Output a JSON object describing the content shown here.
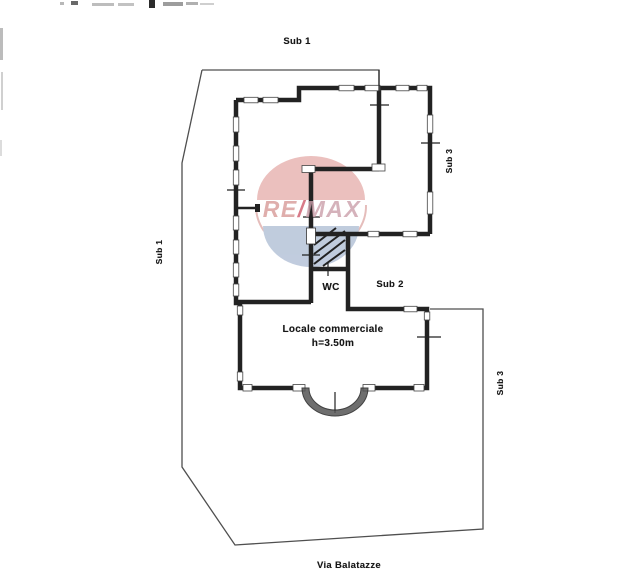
{
  "labels": {
    "sub1_top": "Sub 1",
    "sub1_left": "Sub 1",
    "sub3_upper": "Sub 3",
    "sub2": "Sub 2",
    "wc": "WC",
    "sub3_lower": "Sub 3",
    "room_name": "Locale commerciale",
    "room_height": "h=3.50m",
    "street": "Via Balatazze"
  },
  "watermark": {
    "re": "RE",
    "slash": "/",
    "max": "MAX",
    "colors": {
      "balloon_top": "#e4a9a6",
      "balloon_bottom": "#a9b9d1",
      "text": "#d89a98",
      "slash": "#cf5a6b"
    }
  },
  "drawing": {
    "wall_color": "#222222",
    "boundary_color": "#4f4f4f"
  }
}
